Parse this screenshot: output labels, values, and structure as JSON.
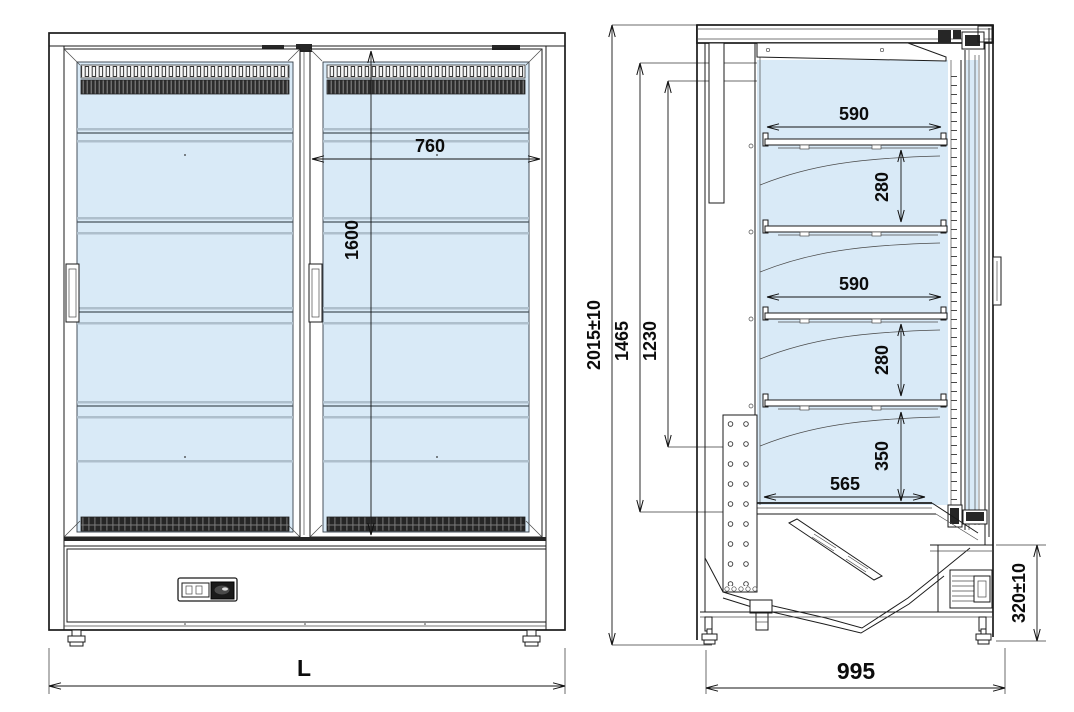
{
  "drawing_title": "Multideck display cooler - front and side elevation",
  "colors": {
    "line": "#1b1b1b",
    "glass": "#d9eaf7",
    "grille_dark": "#262626",
    "background": "#ffffff"
  },
  "views": {
    "front": {
      "label": "front-elevation",
      "dimensions": {
        "door_width": "760",
        "door_glass_height": "1600",
        "overall_length": "L"
      }
    },
    "side": {
      "label": "side-section",
      "dimensions": {
        "overall_height": "2015±10",
        "inner_height": "1465",
        "shelf_zone_height": "1230",
        "shelf_depth_upper": "590",
        "shelf_pitch_upper": "280",
        "shelf_depth_lower": "590",
        "shelf_pitch_lower": "280",
        "base_clearance": "350",
        "base_shelf_depth": "565",
        "plinth_height": "320±10",
        "overall_depth": "995"
      }
    }
  }
}
